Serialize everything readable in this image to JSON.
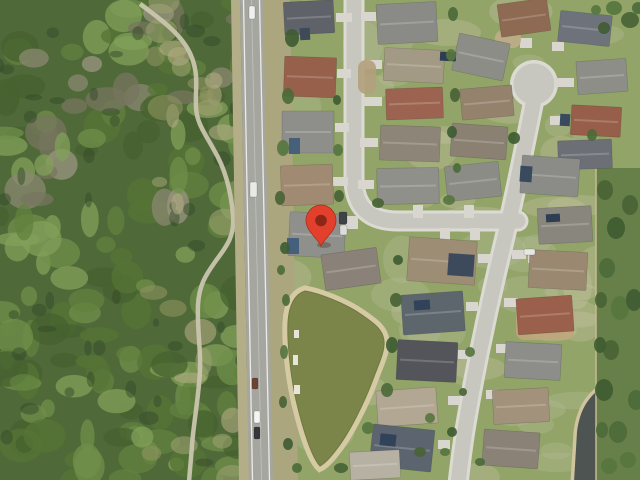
{
  "map": {
    "type": "satellite-aerial-view",
    "marker": {
      "x": 321,
      "y": 246,
      "fill": "#e2402d",
      "stroke": "#a92f1d",
      "dot": "#8c2717",
      "shadow": "rgba(60,40,20,0.3)"
    },
    "palette": {
      "lawn": "#92a468",
      "lawn_pale": [
        "#b8bd9c",
        "#c9c5a8"
      ],
      "forest_base": "#4f6a38",
      "forest_greens": [
        "#46622f",
        "#557436",
        "#62823f",
        "#6f8f4a",
        "#81a05a"
      ],
      "forest_grays": [
        "#8b8872",
        "#77755f",
        "#9a9680"
      ],
      "forest_shadow": "#35492a",
      "scrub": [
        "#9aa06e",
        "#b0ab82",
        "#8d925f"
      ],
      "trail": "#c9c5ae",
      "road": "#a6a6a1",
      "road_line": "#ecebe5",
      "road_center": "#c2c2bc",
      "shoulder_left": "#b3ad88",
      "verge": "#aba67e",
      "sidewalk": "#dcdbd3",
      "street": "#c7c6bf",
      "driveway": "#d8d6ce",
      "pond_bank": "#d5caa3",
      "pond_water": "#7b8449",
      "pond2_bank": "#cfc49d",
      "pond2_water": "#4d5451",
      "strip_green": "#677f49",
      "fence_line": "#c8ba92",
      "tree_greens": [
        "#3f5c33",
        "#4c6b3a",
        "#57763f",
        "#496336"
      ],
      "house_edge": "rgba(40,40,40,0.25)",
      "ridge": "rgba(255,255,255,0.18)",
      "bank_object": "#e8e4da"
    },
    "roads": {
      "main_road_poly": "240,0 263,0 273,480 249,480",
      "shoulder_left_poly": "231,0 240,0 249,480 239,480",
      "verge_right_poly": "263,0 290,0 298,480 273,480",
      "edge_line_left": "M243.5,0 L252.5,480",
      "edge_line_right": "M259.5,0 L269.5,480",
      "center_line": "M251.5,0 L261.5,480"
    },
    "trail": "M140,4 C165,22 185,38 192,58 C199,76 195,92 196,108 C197,124 206,135 214,150 C226,170 231,192 233,215 C235,238 225,248 215,262 C205,276 199,286 198,305 C197,330 201,350 200,370 C199,395 194,420 192,445 C191,460 190,468 189,482",
    "streets": [
      "M354,-6 L354,178 Q354,221 398,221 L518,221",
      "M534,100 C522,160 516,190 508,224 C500,258 490,300 484,330 C477,362 470,400 466,424 C462,448 460,466 458,484"
    ],
    "culdesac": {
      "cx": 534,
      "cy": 84,
      "r": 24
    },
    "forest_clip": {
      "x": 0,
      "y": 0,
      "w": 247,
      "h": 480
    },
    "pond": {
      "water": "M305,291 C318,293 345,303 362,315 C375,324 383,330 384,341 C385,352 378,365 372,382 C364,403 350,432 336,450 C330,458 324,464 320,466 C312,458 303,430 296,400 C290,373 287,340 288,322 C289,305 295,294 305,291 Z",
      "bank_width": 11
    },
    "pond2": {
      "water": "M642,372 C622,377 605,383 595,393 C584,403 579,416 577,432 L574,482 L642,482 Z",
      "bank_width": 7
    },
    "right_strip": {
      "x": 596,
      "y": 168,
      "w": 44,
      "h": 312
    },
    "ground_patches": [
      [
        516,
        306,
        58,
        34,
        "#c0a67c"
      ],
      [
        358,
        60,
        18,
        34,
        "#b3a07c"
      ],
      [
        495,
        30,
        26,
        18,
        "#bfae88"
      ]
    ],
    "houses": [
      [
        284,
        1,
        50,
        33,
        -3,
        "#5f6268"
      ],
      [
        284,
        57,
        52,
        40,
        2,
        "#96604b"
      ],
      [
        282,
        111,
        52,
        42,
        0,
        "#8e8e8a"
      ],
      [
        281,
        165,
        52,
        40,
        -2,
        "#a08a72"
      ],
      [
        289,
        213,
        56,
        44,
        3,
        "#8f908c"
      ],
      [
        323,
        251,
        56,
        36,
        -8,
        "#8a8278"
      ],
      [
        377,
        3,
        60,
        40,
        -3,
        "#8a8a86"
      ],
      [
        384,
        49,
        60,
        33,
        3,
        "#a39a85"
      ],
      [
        386,
        88,
        57,
        31,
        -2,
        "#9c6450"
      ],
      [
        380,
        126,
        60,
        35,
        2,
        "#8d8577"
      ],
      [
        377,
        168,
        62,
        36,
        -1,
        "#90908b"
      ],
      [
        455,
        38,
        52,
        38,
        12,
        "#8d8d88"
      ],
      [
        461,
        87,
        52,
        31,
        -5,
        "#95826d"
      ],
      [
        451,
        125,
        56,
        33,
        4,
        "#8a8173"
      ],
      [
        499,
        1,
        50,
        33,
        -8,
        "#8e6a52"
      ],
      [
        559,
        13,
        52,
        31,
        6,
        "#6e727a"
      ],
      [
        577,
        60,
        50,
        33,
        -4,
        "#8e8e89"
      ],
      [
        571,
        106,
        50,
        30,
        3,
        "#975f49"
      ],
      [
        558,
        140,
        54,
        29,
        -2,
        "#6c6f75"
      ],
      [
        446,
        164,
        54,
        35,
        -6,
        "#8c8c86"
      ],
      [
        521,
        157,
        58,
        38,
        4,
        "#8b8b87"
      ],
      [
        538,
        207,
        54,
        36,
        -3,
        "#89877d"
      ],
      [
        529,
        251,
        58,
        38,
        3,
        "#9a8970"
      ],
      [
        517,
        297,
        56,
        36,
        -4,
        "#9b604b"
      ],
      [
        505,
        343,
        56,
        36,
        3,
        "#8d8d89"
      ],
      [
        493,
        389,
        56,
        34,
        -3,
        "#a2927b"
      ],
      [
        483,
        431,
        56,
        36,
        4,
        "#8a8277"
      ],
      [
        408,
        239,
        68,
        44,
        4,
        "#9c8d74"
      ],
      [
        402,
        293,
        62,
        40,
        -4,
        "#5d666d"
      ],
      [
        397,
        341,
        60,
        40,
        3,
        "#54555a"
      ],
      [
        377,
        389,
        60,
        36,
        -4,
        "#b2a792"
      ],
      [
        371,
        427,
        62,
        42,
        6,
        "#5c646f"
      ],
      [
        350,
        451,
        50,
        28,
        -3,
        "#b7b1a3"
      ]
    ],
    "house_details": [
      [
        289,
        138,
        11,
        16,
        0,
        "#46607a"
      ],
      [
        287,
        238,
        12,
        16,
        0,
        "#44607a"
      ],
      [
        300,
        28,
        10,
        12,
        -3,
        "#3e4a58"
      ],
      [
        440,
        52,
        16,
        9,
        3,
        "#2e3d52"
      ],
      [
        448,
        254,
        26,
        22,
        4,
        "#3d4a5c"
      ],
      [
        414,
        300,
        16,
        10,
        -4,
        "#31435a"
      ],
      [
        520,
        166,
        12,
        16,
        4,
        "#3a4a5e"
      ],
      [
        546,
        214,
        14,
        8,
        -3,
        "#2e3d52"
      ],
      [
        560,
        114,
        10,
        12,
        3,
        "#3a4a5e"
      ],
      [
        380,
        434,
        16,
        12,
        6,
        "#31435a"
      ]
    ],
    "driveways": [
      [
        336,
        13,
        16,
        9
      ],
      [
        337,
        69,
        14,
        9
      ],
      [
        335,
        123,
        14,
        9
      ],
      [
        333,
        177,
        15,
        9
      ],
      [
        342,
        216,
        16,
        13
      ],
      [
        361,
        12,
        15,
        9
      ],
      [
        362,
        60,
        20,
        9
      ],
      [
        362,
        97,
        20,
        9
      ],
      [
        360,
        138,
        18,
        9
      ],
      [
        358,
        180,
        16,
        9
      ],
      [
        520,
        38,
        12,
        10
      ],
      [
        552,
        42,
        12,
        9
      ],
      [
        554,
        78,
        20,
        9
      ],
      [
        550,
        116,
        18,
        9
      ],
      [
        413,
        205,
        10,
        13
      ],
      [
        464,
        205,
        10,
        13
      ],
      [
        440,
        228,
        10,
        12
      ],
      [
        470,
        228,
        10,
        12
      ],
      [
        512,
        250,
        14,
        9
      ],
      [
        504,
        298,
        14,
        9
      ],
      [
        496,
        344,
        12,
        9
      ],
      [
        486,
        390,
        12,
        9
      ],
      [
        478,
        254,
        12,
        9
      ],
      [
        466,
        302,
        12,
        9
      ],
      [
        458,
        350,
        12,
        9
      ],
      [
        448,
        396,
        12,
        9
      ],
      [
        438,
        440,
        12,
        9
      ],
      [
        528,
        255,
        12,
        8
      ]
    ],
    "trees": [
      [
        292,
        38,
        7,
        9
      ],
      [
        288,
        96,
        6,
        8
      ],
      [
        283,
        148,
        6,
        8
      ],
      [
        280,
        198,
        5,
        7
      ],
      [
        285,
        248,
        5,
        6
      ],
      [
        281,
        270,
        4,
        5
      ],
      [
        338,
        150,
        5,
        6
      ],
      [
        339,
        196,
        5,
        6
      ],
      [
        337,
        100,
        4,
        5
      ],
      [
        453,
        14,
        5,
        7
      ],
      [
        451,
        55,
        5,
        6
      ],
      [
        455,
        95,
        5,
        7
      ],
      [
        452,
        132,
        5,
        6
      ],
      [
        457,
        168,
        4,
        5
      ],
      [
        449,
        200,
        6,
        5
      ],
      [
        396,
        300,
        6,
        7
      ],
      [
        392,
        345,
        6,
        8
      ],
      [
        387,
        390,
        6,
        7
      ],
      [
        368,
        428,
        6,
        6
      ],
      [
        341,
        468,
        7,
        5
      ],
      [
        398,
        260,
        5,
        5
      ],
      [
        286,
        300,
        4,
        6
      ],
      [
        284,
        352,
        4,
        7
      ],
      [
        283,
        402,
        4,
        6
      ],
      [
        288,
        444,
        5,
        6
      ],
      [
        297,
        468,
        5,
        5
      ],
      [
        470,
        352,
        5,
        5
      ],
      [
        463,
        392,
        4,
        4
      ],
      [
        452,
        432,
        5,
        5
      ],
      [
        480,
        462,
        5,
        4
      ],
      [
        430,
        418,
        5,
        5
      ],
      [
        605,
        190,
        8,
        10
      ],
      [
        616,
        228,
        9,
        11
      ],
      [
        607,
        268,
        8,
        10
      ],
      [
        620,
        308,
        9,
        12
      ],
      [
        611,
        350,
        8,
        10
      ],
      [
        604,
        390,
        9,
        11
      ],
      [
        618,
        432,
        9,
        11
      ],
      [
        609,
        466,
        8,
        8
      ],
      [
        630,
        205,
        8,
        10
      ],
      [
        634,
        300,
        8,
        11
      ],
      [
        636,
        400,
        8,
        10
      ],
      [
        628,
        460,
        8,
        8
      ],
      [
        601,
        300,
        6,
        8
      ],
      [
        600,
        345,
        6,
        8
      ],
      [
        602,
        430,
        6,
        8
      ],
      [
        614,
        8,
        8,
        7
      ],
      [
        630,
        20,
        9,
        8
      ],
      [
        604,
        28,
        6,
        6
      ],
      [
        638,
        8,
        6,
        6
      ],
      [
        596,
        10,
        5,
        5
      ],
      [
        378,
        203,
        6,
        5
      ],
      [
        514,
        138,
        6,
        6
      ],
      [
        592,
        135,
        5,
        6
      ],
      [
        445,
        452,
        5,
        4
      ],
      [
        420,
        452,
        6,
        5
      ]
    ],
    "bank_objects": [
      [
        294,
        330,
        5,
        8
      ],
      [
        293,
        355,
        5,
        10
      ],
      [
        294,
        385,
        6,
        9
      ]
    ],
    "vehicles": [
      [
        249,
        6,
        6,
        13,
        "#eff0ee"
      ],
      [
        250,
        182,
        7,
        15,
        "#e9eae8"
      ],
      [
        252,
        378,
        6,
        11,
        "#6d4434"
      ],
      [
        254,
        411,
        6,
        12,
        "#f5f5f3"
      ],
      [
        254,
        427,
        6,
        12,
        "#35373b"
      ],
      [
        339,
        212,
        8,
        12,
        "#3f4246"
      ],
      [
        340,
        225,
        7,
        10,
        "#dcdcd8"
      ],
      [
        524,
        249,
        11,
        6,
        "#e6e6e2"
      ]
    ]
  }
}
